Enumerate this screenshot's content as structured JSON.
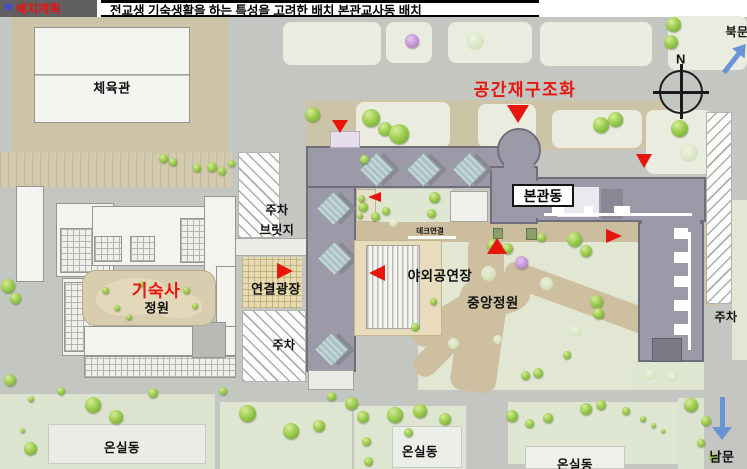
{
  "header": {
    "marker": "✱",
    "section_label": "배치계획",
    "title": "전교생 기숙생활을 하는 특성을 고려한 배치 본관교사동 배치"
  },
  "labels": {
    "gym": "체육관",
    "dorm": "기숙사",
    "dorm_garden": "정원",
    "space_restructure": "공간재구조화",
    "main_building": "본관동",
    "parking_top": "주차",
    "bridge": "브릿지",
    "connect_plaza": "연결광장",
    "parking_mid": "주차",
    "deck_connect": "데크연결",
    "outdoor_stage": "야외공연장",
    "central_garden": "중앙정원",
    "parking_right": "주차",
    "greenhouse_1": "온실동",
    "greenhouse_2": "온실동",
    "greenhouse_3": "온실동",
    "north_gate": "북문",
    "south_gate": "남문",
    "compass_n": "N"
  },
  "colors": {
    "accent_red": "#e8150c",
    "marker_red": "#e8150c",
    "building_gray": "#9c99a8",
    "road_gray": "#c4c6c2",
    "ground_tan": "#cdc3a7",
    "lawn_green": "#e1e7d3",
    "tree_green": "#8abc45",
    "arrow_blue": "#6894d6"
  },
  "map": {
    "trees": [
      [
        312,
        114,
        15
      ],
      [
        371,
        118,
        18
      ],
      [
        385,
        129,
        14
      ],
      [
        399,
        134,
        20
      ],
      [
        364,
        159,
        9
      ],
      [
        412,
        41,
        14,
        "p"
      ],
      [
        475,
        41,
        18,
        "s"
      ],
      [
        601,
        125,
        16
      ],
      [
        615,
        119,
        15
      ],
      [
        679,
        128,
        17
      ],
      [
        688,
        152,
        19,
        "s"
      ],
      [
        673,
        24,
        15
      ],
      [
        671,
        42,
        14
      ],
      [
        163,
        158,
        9
      ],
      [
        173,
        162,
        8
      ],
      [
        197,
        168,
        8
      ],
      [
        212,
        167,
        10
      ],
      [
        222,
        171,
        8
      ],
      [
        231,
        163,
        7
      ],
      [
        8,
        286,
        14
      ],
      [
        15,
        298,
        11
      ],
      [
        10,
        380,
        12
      ],
      [
        105,
        290,
        7
      ],
      [
        117,
        308,
        6
      ],
      [
        141,
        284,
        6
      ],
      [
        186,
        290,
        7
      ],
      [
        195,
        306,
        6
      ],
      [
        129,
        317,
        6
      ],
      [
        363,
        207,
        10
      ],
      [
        375,
        216,
        9
      ],
      [
        386,
        211,
        8
      ],
      [
        434,
        197,
        11
      ],
      [
        431,
        213,
        9
      ],
      [
        393,
        222,
        9,
        "s"
      ],
      [
        361,
        198,
        7
      ],
      [
        360,
        216,
        6
      ],
      [
        493,
        245,
        13
      ],
      [
        507,
        248,
        11
      ],
      [
        574,
        239,
        15
      ],
      [
        586,
        251,
        12
      ],
      [
        541,
        237,
        9
      ],
      [
        521,
        262,
        13,
        "p"
      ],
      [
        488,
        273,
        15,
        "s"
      ],
      [
        546,
        283,
        13,
        "s"
      ],
      [
        596,
        301,
        13
      ],
      [
        598,
        313,
        11
      ],
      [
        576,
        331,
        12,
        "s"
      ],
      [
        567,
        355,
        8
      ],
      [
        433,
        301,
        7
      ],
      [
        415,
        327,
        8
      ],
      [
        453,
        343,
        11,
        "s"
      ],
      [
        538,
        373,
        10
      ],
      [
        525,
        375,
        9
      ],
      [
        497,
        339,
        9,
        "s"
      ],
      [
        650,
        374,
        12,
        "s"
      ],
      [
        672,
        376,
        12,
        "s"
      ],
      [
        93,
        405,
        16
      ],
      [
        116,
        417,
        14
      ],
      [
        61,
        391,
        8
      ],
      [
        153,
        393,
        10
      ],
      [
        31,
        399,
        6
      ],
      [
        30,
        448,
        13
      ],
      [
        22,
        430,
        5
      ],
      [
        247,
        413,
        17
      ],
      [
        291,
        431,
        16
      ],
      [
        319,
        426,
        12
      ],
      [
        351,
        403,
        13
      ],
      [
        331,
        396,
        9
      ],
      [
        223,
        391,
        8
      ],
      [
        363,
        417,
        12
      ],
      [
        366,
        441,
        9
      ],
      [
        368,
        461,
        9
      ],
      [
        395,
        415,
        16
      ],
      [
        420,
        411,
        14
      ],
      [
        445,
        419,
        12
      ],
      [
        408,
        432,
        9
      ],
      [
        512,
        416,
        12
      ],
      [
        529,
        423,
        9
      ],
      [
        548,
        418,
        10
      ],
      [
        586,
        409,
        12
      ],
      [
        601,
        405,
        10
      ],
      [
        626,
        411,
        8
      ],
      [
        643,
        419,
        6
      ],
      [
        653,
        425,
        5
      ],
      [
        663,
        431,
        4
      ],
      [
        691,
        405,
        14
      ],
      [
        706,
        421,
        10
      ],
      [
        701,
        443,
        8
      ],
      [
        713,
        457,
        8
      ]
    ],
    "markers": [
      {
        "x": 332,
        "y": 120,
        "w": 16,
        "h": 13,
        "dir": "down"
      },
      {
        "x": 507,
        "y": 105,
        "w": 22,
        "h": 18,
        "dir": "down"
      },
      {
        "x": 636,
        "y": 154,
        "w": 16,
        "h": 14,
        "dir": "down"
      },
      {
        "x": 277,
        "y": 263,
        "w": 16,
        "h": 16,
        "dir": "right"
      },
      {
        "x": 369,
        "y": 265,
        "w": 16,
        "h": 17,
        "dir": "left"
      },
      {
        "x": 368,
        "y": 192,
        "w": 13,
        "h": 11,
        "dir": "left"
      },
      {
        "x": 487,
        "y": 238,
        "w": 20,
        "h": 16,
        "dir": "up"
      },
      {
        "x": 606,
        "y": 229,
        "w": 16,
        "h": 15,
        "dir": "right"
      }
    ]
  }
}
